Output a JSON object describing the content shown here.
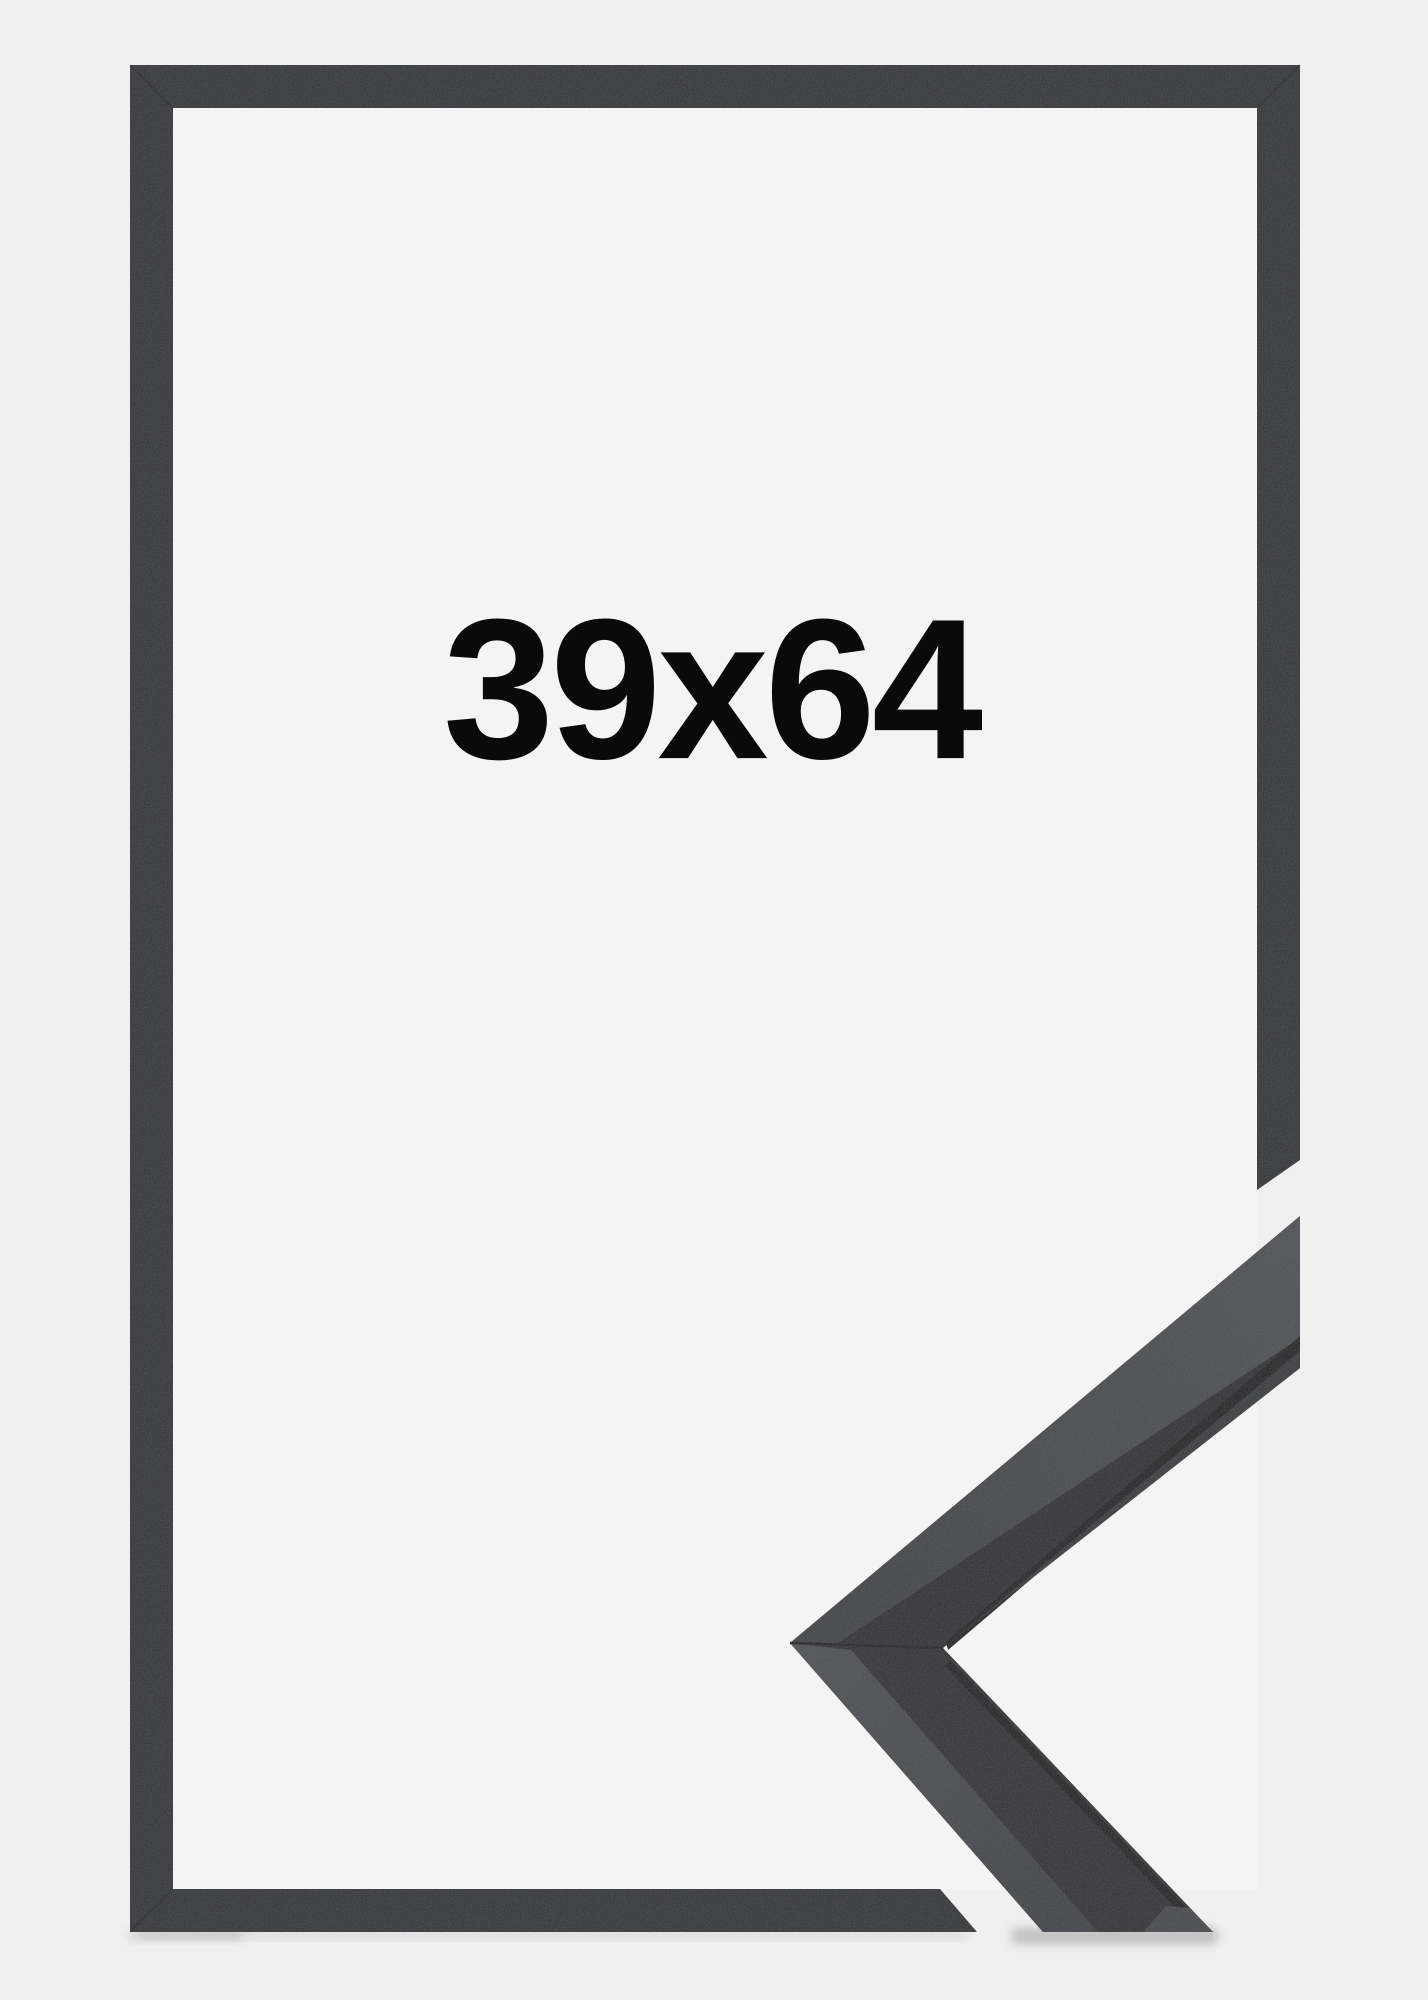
{
  "page": {
    "background_color": "#f0f0f1"
  },
  "frame_preview": {
    "size_label": "39x64",
    "label_color": "#0a0a0a",
    "frame_color": "#2f3134",
    "inner_background_color": "#f4f4f5",
    "corner_photo": {
      "front_face_color": "#2c2d2f",
      "lower_front_face_color": "#2e2f31",
      "sheen_near_color": "#3e4045",
      "sheen_far_color": "#4e5055",
      "groove_color": "#1a1b1d",
      "edge_strip_color": "#37393c",
      "end_cut_color": "#45474b",
      "seam_color": "#1c1d1f"
    }
  }
}
